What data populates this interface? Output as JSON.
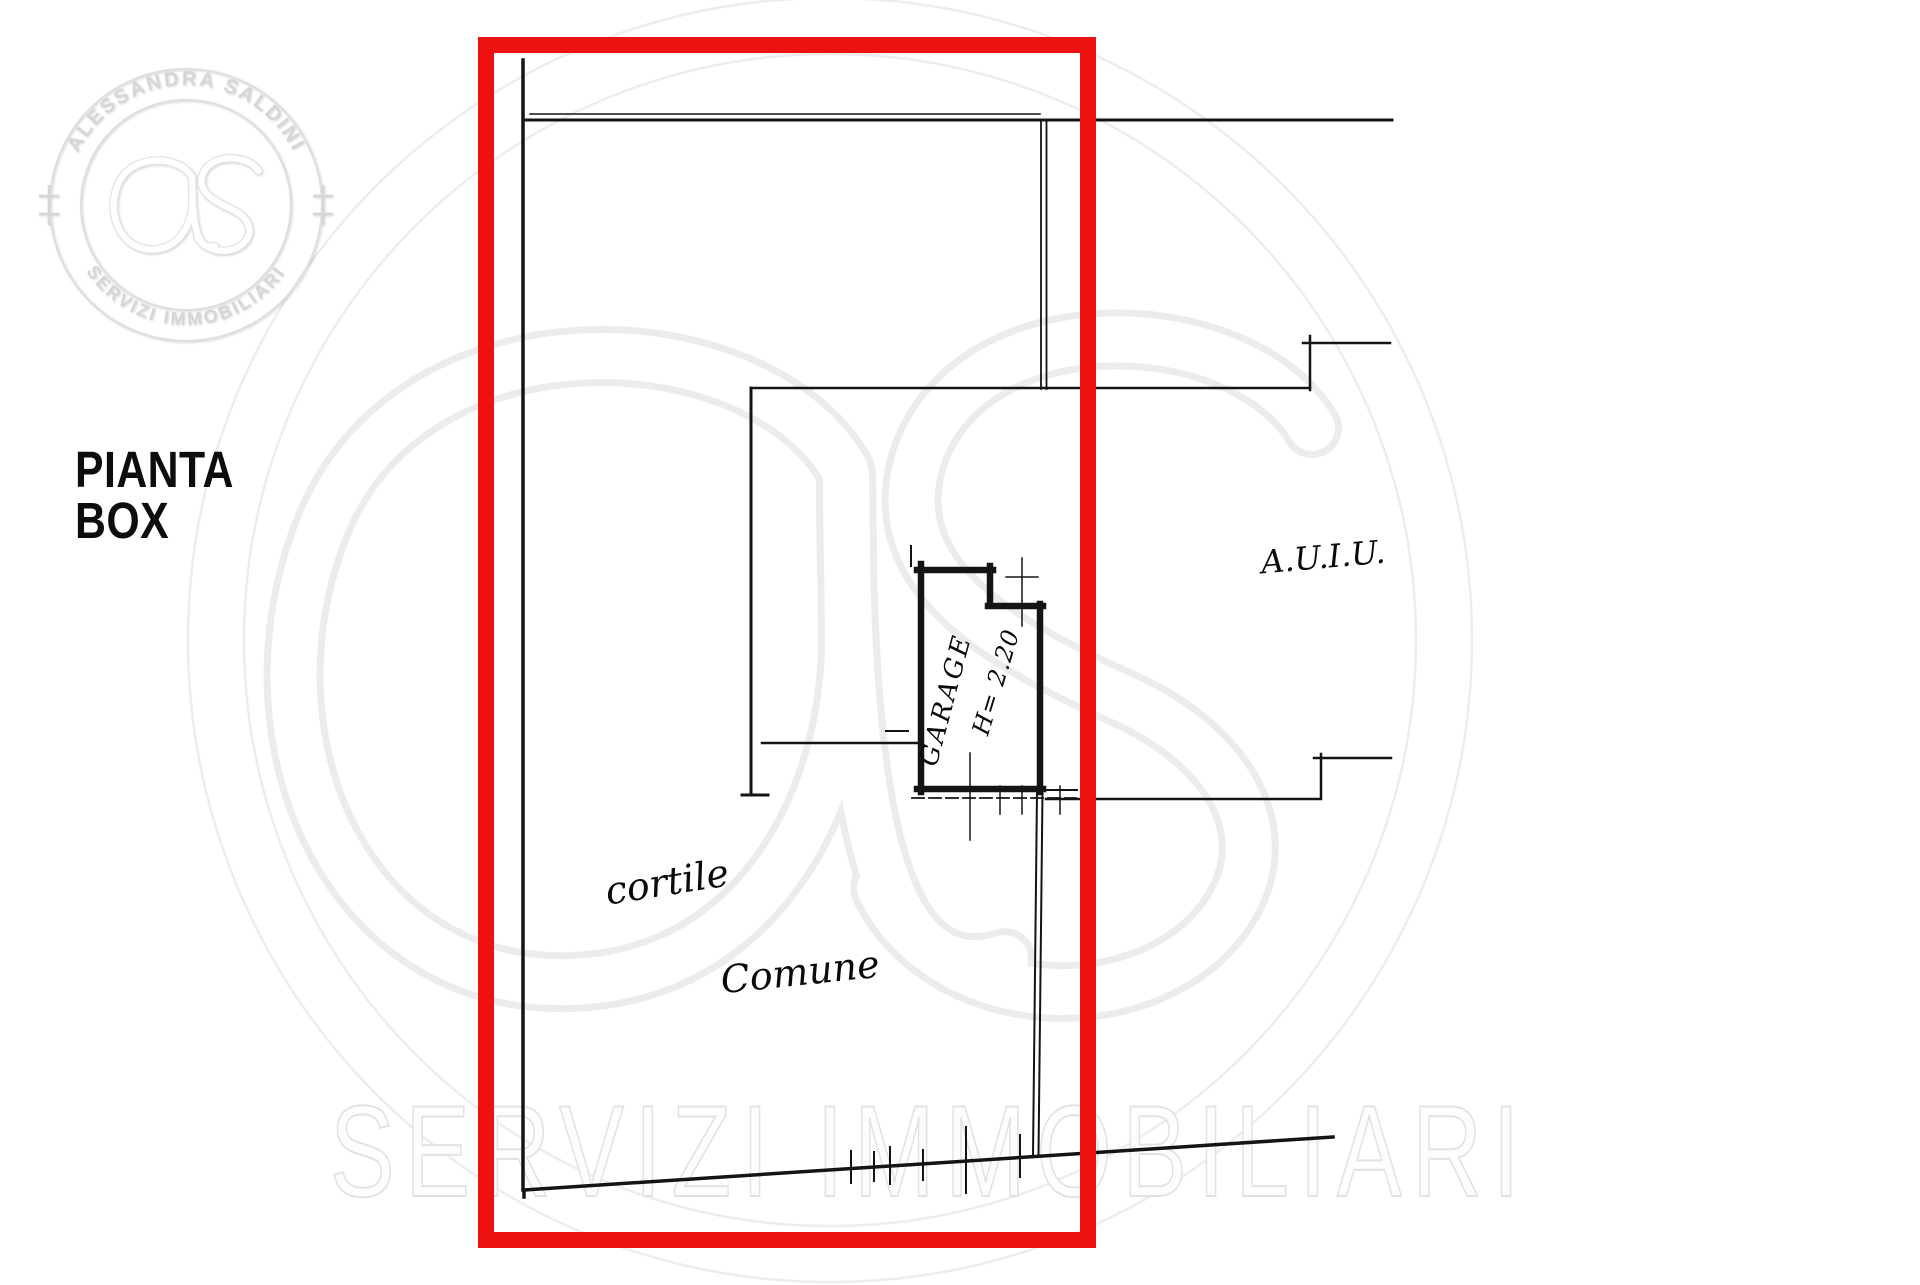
{
  "title": {
    "text": "PIANTA\nBOX"
  },
  "logo": {
    "arc_top": "ALESSANDRA SALDINI",
    "arc_bottom": "SERVIZI IMMOBILIARI",
    "monogram_icon": "as-monogram"
  },
  "plan_labels": {
    "cortile": "cortile",
    "comune": "Comune",
    "garage": "GARAGE",
    "garage_height": "H= 2.20",
    "right_annotation": "A.U.I.U."
  },
  "watermark": {
    "text": "SERVIZI IMMOBILIARI"
  },
  "colors": {
    "highlight_red": "#ee1111",
    "line_black": "#141414",
    "watermark_gray": "#ececec"
  }
}
